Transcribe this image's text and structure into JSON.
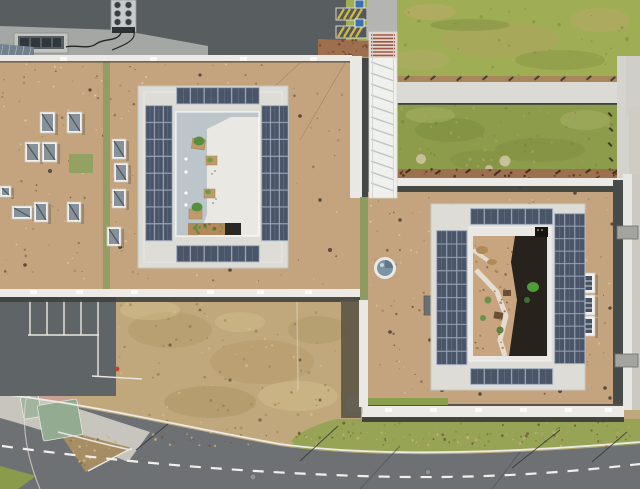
{
  "scene_label": "aerial-view-two-buildings-solar-roofs",
  "colors": {
    "field_dry": "#c0a87c",
    "road": "#6e7173",
    "asphalt_parking": "#5f6467",
    "asphalt_top": "#585d60",
    "concrete_apron": "#a4a7a4",
    "sidewalk": "#c8c5be",
    "lawn": "#9fad55",
    "green_roof": "#8c9c4a",
    "grass_strip": "#98a455",
    "gravel_roof": "#c4a47f",
    "parapet_white": "#eceae6",
    "ring_white": "#dedcd6",
    "courtyard_floor": "#eae8e2",
    "courtyard_shadow": "#b6c1c8",
    "solar_panel": "#4b5568",
    "solar_frame": "#b9c1cb",
    "walkway_white": "#f0f0ed",
    "walkway_stripe": "#b6bcc2",
    "rung_red": "#9c5742",
    "shadow_dark": "#434745",
    "shelter_green_1": "#a3b59e",
    "shelter_green_2": "#93ab91",
    "pink_path": "#c7a193",
    "dirt": "#a78d64",
    "gravel_red": "#9c7150",
    "hatch_yellow": "#d4b845",
    "badge_blue": "#3d6fae",
    "dome_glass": "#7b93a2",
    "olive_strip": "#8d9b60",
    "sand_court": "#c8a57e",
    "court_dark": "#201d18",
    "plant_green": "#4f9d38",
    "hvac_body": "#c7cbcd",
    "cable_black": "#222526",
    "hydrant_red": "#c53f31"
  },
  "solar_arrays": [
    {
      "id": "lb-west",
      "x": 146,
      "y": 106,
      "cols": 3,
      "rows": 8,
      "cw": 8.0,
      "ch": 16.0,
      "gap": 0.9
    },
    {
      "id": "lb-east",
      "x": 262,
      "y": 106,
      "cols": 3,
      "rows": 8,
      "cw": 8.0,
      "ch": 16.0,
      "gap": 0.9
    },
    {
      "id": "lb-north",
      "x": 177,
      "y": 88,
      "cols": 6,
      "rows": 1,
      "cw": 12.8,
      "ch": 15.5,
      "gap": 1.0
    },
    {
      "id": "lb-south",
      "x": 177,
      "y": 246,
      "cols": 6,
      "rows": 1,
      "cw": 12.8,
      "ch": 15.5,
      "gap": 1.0
    },
    {
      "id": "rb-west",
      "x": 437,
      "y": 231,
      "cols": 3,
      "rows": 10,
      "cw": 9.3,
      "ch": 12.6,
      "gap": 0.8
    },
    {
      "id": "rb-east",
      "x": 555,
      "y": 214,
      "cols": 3,
      "rows": 12,
      "cw": 9.3,
      "ch": 11.7,
      "gap": 0.8
    },
    {
      "id": "rb-north",
      "x": 471,
      "y": 209,
      "cols": 6,
      "rows": 1,
      "cw": 12.7,
      "ch": 15.0,
      "gap": 1.0
    },
    {
      "id": "rb-south",
      "x": 471,
      "y": 369,
      "cols": 6,
      "rows": 1,
      "cw": 12.7,
      "ch": 15.0,
      "gap": 1.0
    }
  ],
  "skylights_box": [
    [
      40,
      112,
      15,
      21
    ],
    [
      67,
      112,
      15,
      21
    ],
    [
      25,
      142,
      15,
      20
    ],
    [
      42,
      142,
      15,
      20
    ],
    [
      112,
      139,
      14,
      20
    ],
    [
      114,
      163,
      14,
      19
    ],
    [
      112,
      189,
      14,
      19
    ],
    [
      12,
      206,
      20,
      13
    ],
    [
      34,
      202,
      14,
      20
    ],
    [
      67,
      202,
      14,
      20
    ],
    [
      107,
      227,
      14,
      19
    ],
    [
      0,
      186,
      11,
      11
    ]
  ],
  "skylights_louver": [
    [
      577,
      273,
      18,
      20
    ],
    [
      577,
      295,
      18,
      20
    ],
    [
      577,
      316,
      18,
      20
    ]
  ],
  "parking_lines": [
    [
      30,
      300,
      30,
      335
    ],
    [
      47,
      300,
      47,
      335
    ],
    [
      64,
      300,
      64,
      335
    ],
    [
      81,
      300,
      81,
      335
    ],
    [
      98,
      300,
      98,
      335
    ],
    [
      28,
      335,
      99,
      335
    ],
    [
      98,
      335,
      98,
      377
    ],
    [
      92,
      376,
      142,
      379
    ]
  ],
  "parapet_ticks": [
    [
      30,
      290
    ],
    [
      76,
      290
    ],
    [
      131,
      290
    ],
    [
      207,
      290
    ],
    [
      257,
      290
    ],
    [
      305,
      290
    ],
    [
      60,
      57
    ],
    [
      150,
      57
    ],
    [
      240,
      57
    ],
    [
      310,
      57
    ],
    [
      385,
      408
    ],
    [
      430,
      408
    ],
    [
      475,
      408
    ],
    [
      520,
      408
    ],
    [
      565,
      408
    ],
    [
      605,
      408
    ]
  ],
  "dashes": [
    {
      "target": "dash-dirt-strip",
      "color": "#453f33",
      "w": 6,
      "h": 2,
      "angle": -40,
      "points": [
        [
          404,
          79
        ],
        [
          430,
          79
        ],
        [
          456,
          80
        ],
        [
          482,
          79
        ],
        [
          508,
          80
        ],
        [
          534,
          79
        ],
        [
          560,
          80
        ],
        [
          586,
          79
        ],
        [
          610,
          80
        ]
      ]
    },
    {
      "target": "dash-gravel-strip",
      "color": "#4a2c1e",
      "w": 6,
      "h": 2,
      "angle": -35,
      "points": [
        [
          405,
          172
        ],
        [
          435,
          173
        ],
        [
          465,
          172
        ],
        [
          495,
          173
        ],
        [
          525,
          172
        ],
        [
          555,
          173
        ],
        [
          585,
          172
        ],
        [
          612,
          173
        ]
      ]
    },
    {
      "target": "dash-greenroof-edge",
      "color": "#3e382c",
      "w": 5,
      "h": 2,
      "angle": 45,
      "points": [
        [
          609,
          112
        ],
        [
          610,
          127
        ],
        [
          609,
          142
        ],
        [
          610,
          157
        ]
      ]
    }
  ],
  "blobs": [
    {
      "target": "blobs-left-roof",
      "color": "#443c30",
      "points": [
        [
          153,
          152,
          2.4
        ],
        [
          50,
          171,
          2
        ],
        [
          120,
          247,
          2
        ],
        [
          300,
          116,
          1.8
        ],
        [
          330,
          250,
          2
        ],
        [
          25,
          265,
          1.8
        ],
        [
          200,
          75,
          1.6
        ],
        [
          320,
          200,
          1.7
        ],
        [
          230,
          270,
          1.8
        ],
        [
          90,
          90,
          1.6
        ]
      ]
    },
    {
      "target": "blobs-right-roof",
      "color": "#453d31",
      "points": [
        [
          447,
          184,
          2
        ],
        [
          520,
          188,
          2
        ],
        [
          575,
          193,
          1.8
        ],
        [
          442,
          390,
          2
        ],
        [
          480,
          394,
          1.8
        ],
        [
          560,
          391,
          2
        ],
        [
          605,
          388,
          1.8
        ],
        [
          430,
          340,
          1.8
        ],
        [
          610,
          308,
          1.7
        ],
        [
          400,
          220,
          1.7
        ],
        [
          390,
          332,
          1.8
        ],
        [
          612,
          224,
          1.6
        ],
        [
          610,
          398,
          1.7
        ],
        [
          470,
          287,
          1.5
        ]
      ]
    },
    {
      "target": "blobs-field",
      "color": "#6d5d3c",
      "points": [
        [
          170,
          345,
          1.6
        ],
        [
          230,
          380,
          1.6
        ],
        [
          300,
          360,
          1.5
        ],
        [
          260,
          420,
          1.6
        ],
        [
          200,
          310,
          1.4
        ],
        [
          320,
          400,
          1.5
        ]
      ]
    }
  ],
  "noise": [
    {
      "target": "noise-left-roof",
      "x": 2,
      "y": 64,
      "w": 346,
      "h": 222,
      "count": 150,
      "rmin": 0.5,
      "rmax": 1.4,
      "colors": [
        "#8a6f50",
        "#a5895f",
        "#6d5438"
      ],
      "opacity": 0.8,
      "seed": 11
    },
    {
      "target": "noise-left-roof",
      "x": 2,
      "y": 64,
      "w": 346,
      "h": 222,
      "count": 70,
      "rmin": 0.5,
      "rmax": 1.2,
      "colors": [
        "#dcc7a2"
      ],
      "opacity": 0.9,
      "seed": 12
    },
    {
      "target": "noise-right-roof",
      "x": 370,
      "y": 196,
      "w": 240,
      "h": 206,
      "count": 140,
      "rmin": 0.5,
      "rmax": 1.4,
      "colors": [
        "#8a6f50",
        "#a5895f",
        "#6d5438"
      ],
      "opacity": 0.8,
      "seed": 21
    },
    {
      "target": "noise-right-roof",
      "x": 370,
      "y": 196,
      "w": 240,
      "h": 206,
      "count": 60,
      "rmin": 0.5,
      "rmax": 1.2,
      "colors": [
        "#dcc7a2"
      ],
      "opacity": 0.9,
      "seed": 22
    },
    {
      "target": "noise-field",
      "x": 118,
      "y": 302,
      "w": 220,
      "h": 135,
      "count": 90,
      "rmin": 0.6,
      "rmax": 1.6,
      "colors": [
        "#a5894f",
        "#8f7747",
        "#d6c08f"
      ],
      "opacity": 0.65,
      "seed": 31
    },
    {
      "target": "noise-lawn",
      "x": 348,
      "y": 2,
      "w": 286,
      "h": 76,
      "count": 70,
      "rmin": 0.7,
      "rmax": 1.8,
      "colors": [
        "#b5a465",
        "#7f9140"
      ],
      "opacity": 0.6,
      "seed": 41
    },
    {
      "target": "noise-greenroof",
      "x": 400,
      "y": 105,
      "w": 213,
      "h": 62,
      "count": 55,
      "rmin": 0.7,
      "rmax": 1.8,
      "colors": [
        "#b5a465",
        "#75863c"
      ],
      "opacity": 0.6,
      "seed": 51
    },
    {
      "target": "noise-grass-strip",
      "x": 340,
      "y": 420,
      "w": 296,
      "h": 22,
      "count": 70,
      "rmin": 0.6,
      "rmax": 1.5,
      "colors": [
        "#b3a06a",
        "#7f9140",
        "#5f512f"
      ],
      "opacity": 0.75,
      "seed": 61
    },
    {
      "target": "noise-dirt-triangle",
      "x": 60,
      "y": 432,
      "w": 64,
      "h": 34,
      "count": 28,
      "rmin": 0.6,
      "rmax": 1.5,
      "colors": [
        "#7d6643",
        "#c9b38b"
      ],
      "opacity": 0.8,
      "seed": 71
    },
    {
      "target": "noise-verge",
      "x": 150,
      "y": 432,
      "w": 486,
      "h": 14,
      "count": 80,
      "rmin": 0.6,
      "rmax": 1.5,
      "colors": [
        "#6e5a38",
        "#c9b183"
      ],
      "opacity": 0.8,
      "seed": 81
    },
    {
      "target": "noise-gravel-top",
      "x": 318,
      "y": 40,
      "w": 52,
      "h": 15,
      "count": 22,
      "rmin": 0.6,
      "rmax": 1.3,
      "colors": [
        "#6f3f2b"
      ],
      "opacity": 0.8,
      "seed": 91
    },
    {
      "target": "noise-gravel-green",
      "x": 398,
      "y": 169,
      "w": 226,
      "h": 9,
      "count": 34,
      "rmin": 0.6,
      "rmax": 1.4,
      "colors": [
        "#6e3f2a",
        "#4a2c1e"
      ],
      "opacity": 0.85,
      "seed": 92
    },
    {
      "target": "noise-court-sand",
      "x": 474,
      "y": 240,
      "w": 38,
      "h": 112,
      "count": 30,
      "rmin": 0.6,
      "rmax": 1.4,
      "colors": [
        "#9a7a50",
        "#7a5c38"
      ],
      "opacity": 0.8,
      "seed": 93
    },
    {
      "target": "noise-bed",
      "x": 189,
      "y": 224,
      "w": 35,
      "h": 10,
      "count": 14,
      "rmin": 0.7,
      "rmax": 1.4,
      "colors": [
        "#7a5a36",
        "#5d8f3e"
      ],
      "opacity": 0.9,
      "seed": 94
    }
  ]
}
